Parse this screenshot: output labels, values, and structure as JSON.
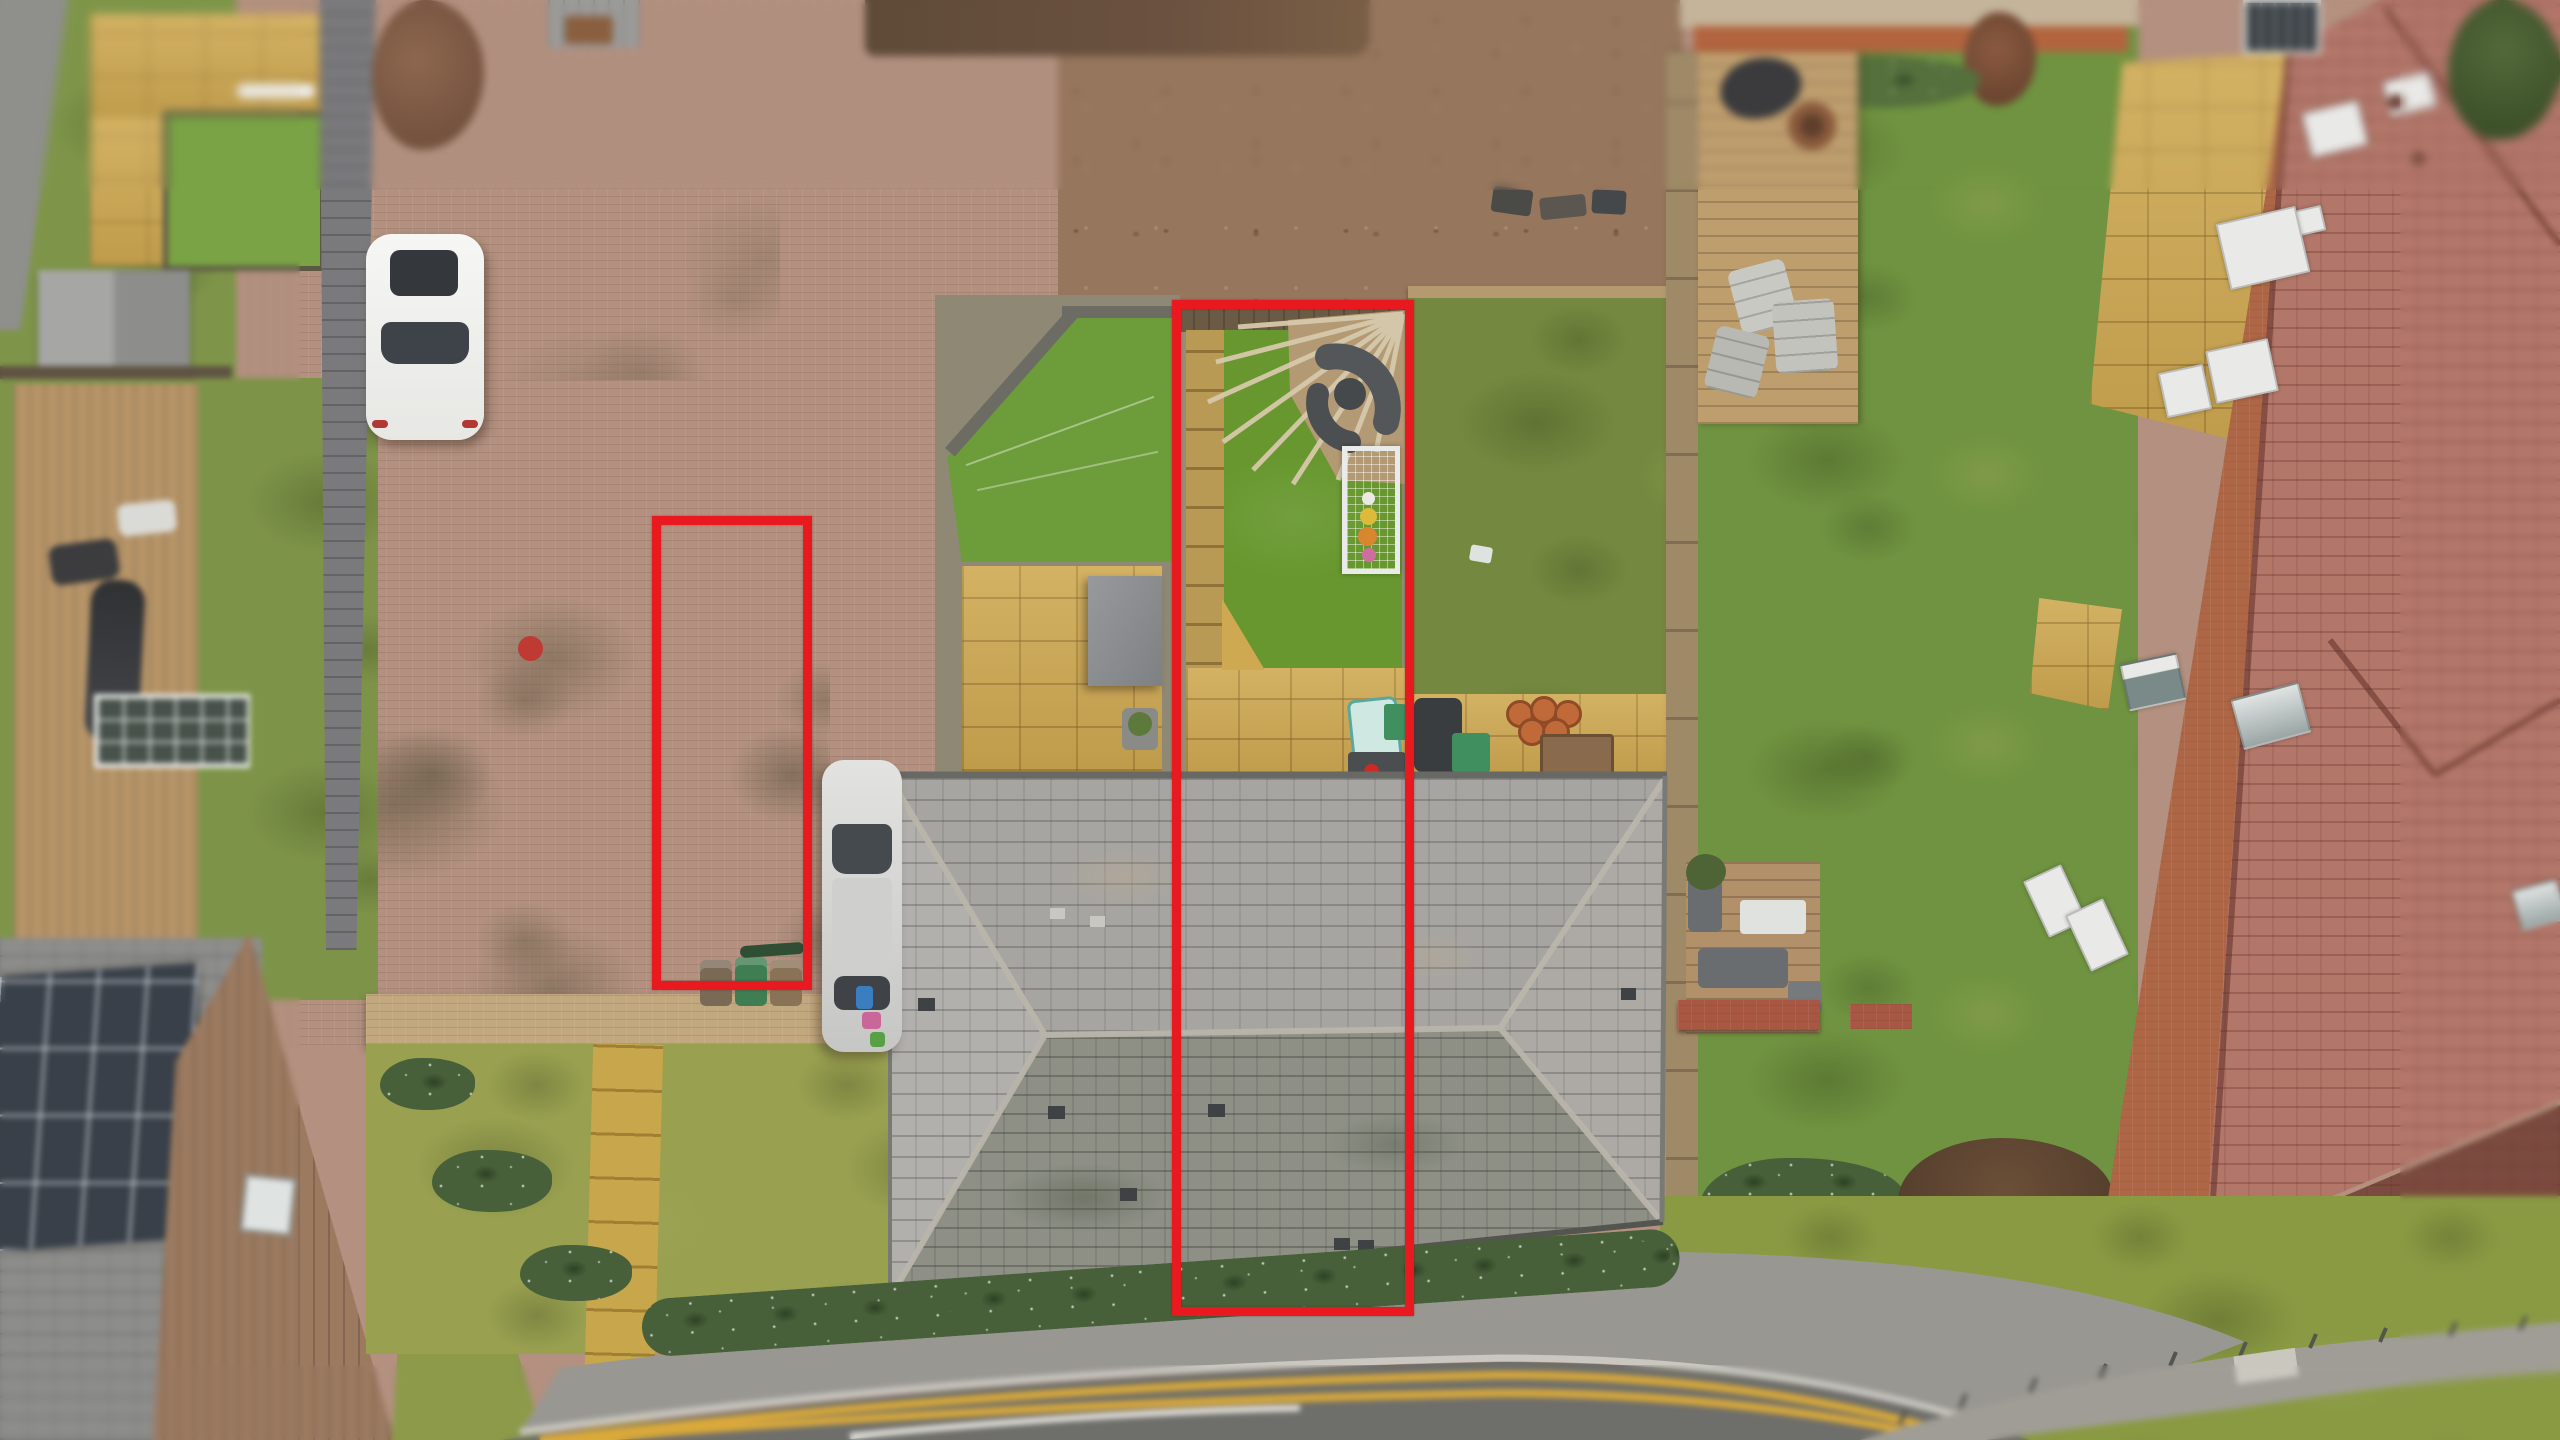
{
  "meta": {
    "type": "aerial-drone-photograph",
    "subject": "overhead view of a residential bungalow plot with red boundary outlines drawn for a property listing",
    "width_px": 2560,
    "height_px": 1440,
    "visible_text": "none"
  },
  "colors": {
    "annotation_red": "#e8191f",
    "artificial_lawn": "#67972e",
    "natural_lawn": "#74883f",
    "brick_drive": "#b3907f",
    "roof_gray": "#a7a5a1",
    "roof_front_gray": "#8e9086",
    "roof_terracotta": "#b3776a",
    "paving_gold": "#cfa952",
    "road_asphalt": "#6e6e6a",
    "road_line_yellow": "#d9a93a",
    "deck_wood": "#bf9e6e",
    "fence_wood": "#9f8a67",
    "white_car": "#f2f2f0",
    "silver_car": "#d6d7d5",
    "bin_green": "#3f7d52",
    "bin_brown": "#7a6a55",
    "goal_white": "#e9ebe9"
  },
  "annotations": {
    "property_boundary": {
      "label": "red outline around the marketed plot: rear garden, middle section of hipped roof and front shrub border",
      "x": 1172,
      "y": 300,
      "width": 242,
      "height": 1016,
      "stroke_px": 9
    },
    "parking_bay_boundary": {
      "label": "red outline around the allocated block-paved parking bay on the shared driveway",
      "x": 652,
      "y": 516,
      "width": 160,
      "height": 474,
      "stroke_px": 9
    }
  },
  "scene": {
    "areas": [
      {
        "name": "shared-driveway",
        "description": "pink-brown herringbone block paving with moss patches, upper left quadrant"
      },
      {
        "name": "outlined-rear-garden",
        "description": "artificial lawn, corner decking with fan of pergola beams, grey garden furniture, white football goal with balls, gold paved patio and stepping-stone path"
      },
      {
        "name": "main-hipped-roof",
        "description": "large grey slate hipped roof crossing the centre, darker mossy front slope, roof vents"
      },
      {
        "name": "left-neighbour-gardens",
        "description": "lawns, grey shed, timber deck with furniture, greenhouse frame"
      },
      {
        "name": "pentagon-garden",
        "description": "neighbouring artificial lawn with angled fence, gold patio and grey canopy"
      },
      {
        "name": "right-neighbour-garden",
        "description": "large lawn, top decked patio with BBQ and fire pit, lower deck with grey sofas, low brick wall"
      },
      {
        "name": "right-house",
        "description": "large brick house with white windows, terracotta tiled roof, rooflights and gold paved patio"
      },
      {
        "name": "road",
        "description": "curving road with double yellow lines, kerb, footway and shrub border in front of the house"
      },
      {
        "name": "bottom-left-roofs",
        "description": "grey roof with solar panel array and tan tiled roof with rooflight"
      },
      {
        "name": "bottom-right-verge",
        "description": "wide grass verge with curved railed footpath"
      }
    ],
    "objects": [
      {
        "name": "white-car",
        "description": "white car parked nose-down on the driveway, top left"
      },
      {
        "name": "silver-car",
        "description": "silver car parked alongside the left gable of the bungalow"
      },
      {
        "name": "wheelie-bins",
        "description": "brown, green and brown wheelie bins at the foot of the parking bay"
      },
      {
        "name": "football-goal",
        "description": "white goal frame with net and coloured balls on the artificial lawn"
      },
      {
        "name": "garden-furniture-set",
        "description": "dark grey curved sofa set on corner decking under radiating pergola beams"
      },
      {
        "name": "solar-panels",
        "description": "photovoltaic array on the neighbouring grey roof, bottom left"
      },
      {
        "name": "double-yellow-lines",
        "description": "two parallel yellow no-parking lines following the road curve"
      }
    ]
  }
}
